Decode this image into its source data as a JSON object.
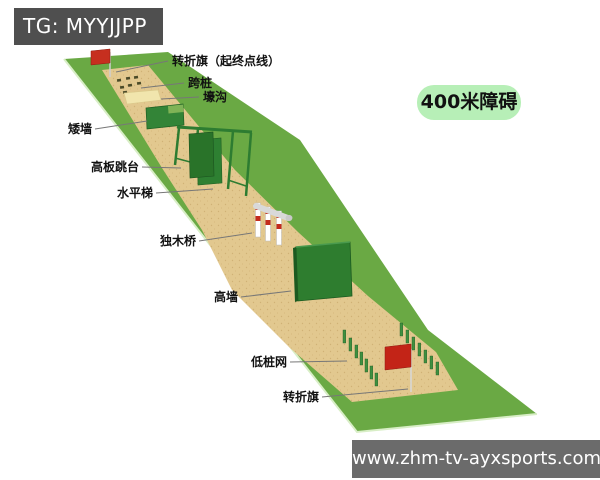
{
  "watermarks": {
    "telegram": "TG: MYYJJPP",
    "website": "www.zhm-tv-ayxsports.com"
  },
  "badge": {
    "label": "400米障碍"
  },
  "course": {
    "title": "400米障碍",
    "labels": [
      {
        "id": "start-finish-turn-flag",
        "text": "转折旗（起终点线）"
      },
      {
        "id": "stepping-stakes",
        "text": "跨桩"
      },
      {
        "id": "trench",
        "text": "壕沟"
      },
      {
        "id": "low-wall",
        "text": "矮墙"
      },
      {
        "id": "high-board-platform",
        "text": "高板跳台"
      },
      {
        "id": "horizontal-ladder",
        "text": "水平梯"
      },
      {
        "id": "balance-beam",
        "text": "独木桥"
      },
      {
        "id": "high-wall",
        "text": "高墙"
      },
      {
        "id": "low-stake-net",
        "text": "低桩网"
      },
      {
        "id": "turn-flag",
        "text": "转折旗"
      }
    ]
  },
  "colors": {
    "grass_green": "#6aa944",
    "sand": "#e2c88f",
    "obstacle_green": "#2e7d32",
    "flag_red": "#c32b1d",
    "badge_bg": "#b7efb7",
    "watermark_dark_bg": "#4f4f4f",
    "watermark_gray_bg": "#6b6b6b"
  }
}
